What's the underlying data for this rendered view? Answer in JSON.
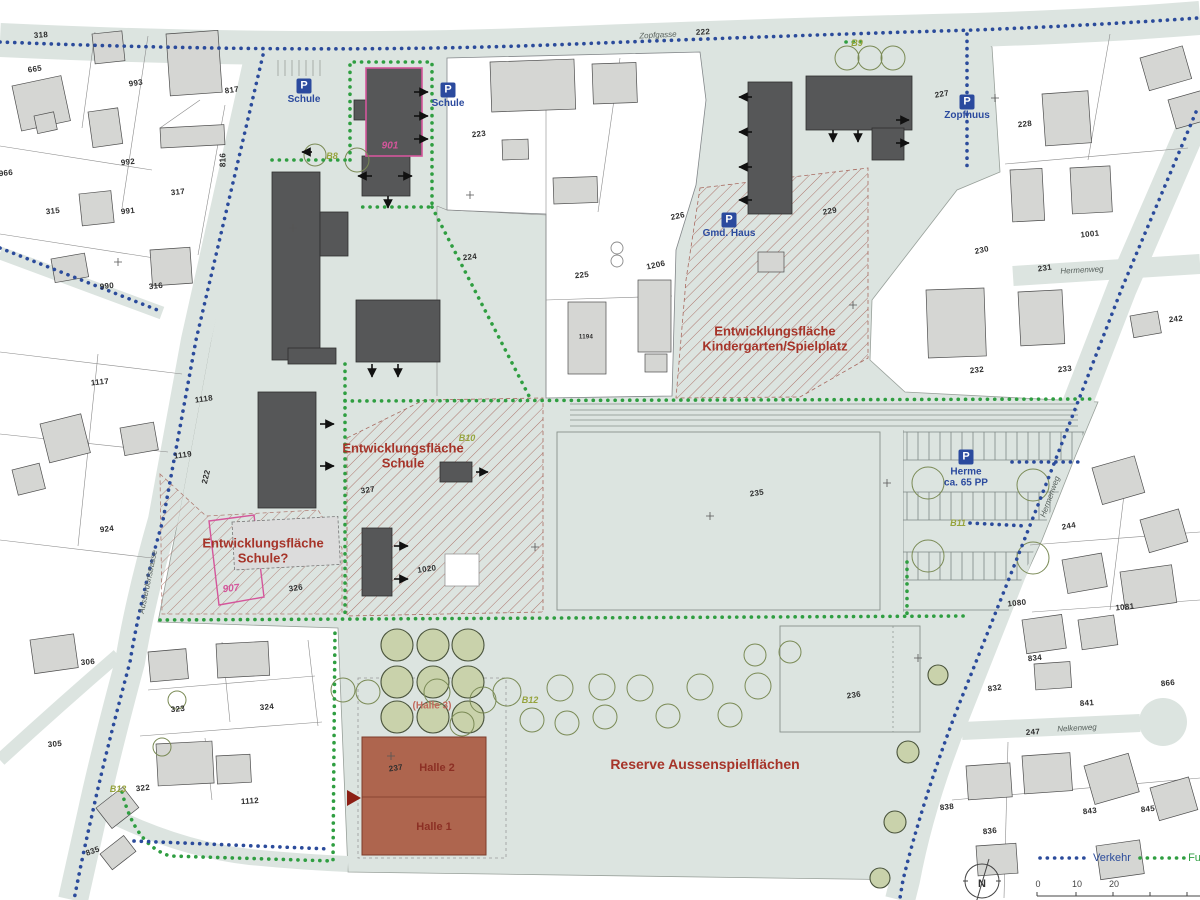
{
  "colors": {
    "campus": "#dce4e0",
    "house": "#d5d6d3",
    "dark_building": "#565758",
    "halle": "#ae654e",
    "hatch": "#a86a60",
    "pink": "#d4569b",
    "olive": "#96a33c",
    "zone_red": "#a63429",
    "verkehr_blue": "#2b4b9b",
    "fussweg_green": "#2f9e41"
  },
  "legend": {
    "verkehr_label": "Verkehr",
    "fuss_label": "Fuss",
    "north_label": "N"
  },
  "scale": {
    "ticks": [
      {
        "text": "0",
        "x": 1038,
        "y": 884
      },
      {
        "text": "10",
        "x": 1077,
        "y": 884
      },
      {
        "text": "20",
        "x": 1114,
        "y": 884
      }
    ]
  },
  "parking": [
    {
      "icon": "P",
      "lines": [
        "Schule"
      ],
      "x": 304,
      "y": 86
    },
    {
      "icon": "P",
      "lines": [
        "Schule"
      ],
      "x": 448,
      "y": 90
    },
    {
      "icon": "P",
      "lines": [
        "Zopfhuus"
      ],
      "x": 967,
      "y": 102
    },
    {
      "icon": "P",
      "lines": [
        "Gmd. Haus"
      ],
      "x": 729,
      "y": 220
    },
    {
      "icon": "P",
      "lines": [
        "Herme",
        "ca. 65 PP"
      ],
      "x": 966,
      "y": 457
    }
  ],
  "zone_labels": [
    {
      "name": "zone-kindergarten",
      "lines": [
        "Entwicklungsfläche",
        "Kindergarten/Spielplatz"
      ],
      "x": 775,
      "y": 339,
      "size": 13
    },
    {
      "name": "zone-schule",
      "lines": [
        "Entwicklungsfläche",
        "Schule"
      ],
      "x": 403,
      "y": 456,
      "size": 13
    },
    {
      "name": "zone-schule-frage",
      "lines": [
        "Entwicklungsfläche",
        "Schule?"
      ],
      "x": 263,
      "y": 551,
      "size": 13
    },
    {
      "name": "zone-reserve",
      "lines": [
        "Reserve Aussenspielflächen"
      ],
      "x": 705,
      "y": 765,
      "size": 14
    },
    {
      "name": "halle-2-label",
      "lines": [
        "Halle 2"
      ],
      "x": 437,
      "y": 768,
      "size": 11,
      "color": "#8c2f24"
    },
    {
      "name": "halle-1-label",
      "lines": [
        "Halle 1"
      ],
      "x": 434,
      "y": 827,
      "size": 11,
      "color": "#8c2f24"
    },
    {
      "name": "halle-3-label",
      "lines": [
        "(Halle 3)"
      ],
      "x": 432,
      "y": 706,
      "size": 10,
      "color": "#c26b5e"
    }
  ],
  "pink_labels": [
    {
      "name": "building-901-label",
      "text": "901",
      "x": 390,
      "y": 146,
      "rot": 0
    },
    {
      "name": "building-907-label",
      "text": "907",
      "x": 231,
      "y": 589,
      "rot": -6
    }
  ],
  "b_labels": [
    {
      "text": "B8",
      "x": 332,
      "y": 156
    },
    {
      "text": "B9",
      "x": 857,
      "y": 43
    },
    {
      "text": "B10",
      "x": 467,
      "y": 438
    },
    {
      "text": "B11",
      "x": 958,
      "y": 523
    },
    {
      "text": "B12",
      "x": 530,
      "y": 700
    },
    {
      "text": "B13",
      "x": 118,
      "y": 789
    }
  ],
  "street_labels": [
    {
      "text": "Zopfgasse",
      "x": 658,
      "y": 36,
      "rot": -3
    },
    {
      "text": "Hermenweg",
      "x": 1082,
      "y": 271,
      "rot": -3
    },
    {
      "text": "Hermenweg",
      "x": 1051,
      "y": 497,
      "rot": -70
    },
    {
      "text": "Nelkenweg",
      "x": 1077,
      "y": 729,
      "rot": -3
    },
    {
      "text": "Ausserdorfstrasse",
      "x": 149,
      "y": 582,
      "rot": -78
    }
  ],
  "parcel_labels": [
    {
      "text": "318",
      "x": 41,
      "y": 36,
      "rot": -4
    },
    {
      "text": "665",
      "x": 35,
      "y": 70,
      "rot": -8
    },
    {
      "text": "993",
      "x": 136,
      "y": 84,
      "rot": -8
    },
    {
      "text": "817",
      "x": 232,
      "y": 91,
      "rot": -8
    },
    {
      "text": "992",
      "x": 128,
      "y": 163,
      "rot": -6
    },
    {
      "text": "816",
      "x": 224,
      "y": 160,
      "rot": -90
    },
    {
      "text": "991",
      "x": 128,
      "y": 212,
      "rot": -6
    },
    {
      "text": "315",
      "x": 53,
      "y": 212,
      "rot": -6
    },
    {
      "text": "317",
      "x": 178,
      "y": 193,
      "rot": -6
    },
    {
      "text": "966",
      "x": 6,
      "y": 174,
      "rot": -6
    },
    {
      "text": "990",
      "x": 107,
      "y": 287,
      "rot": -6
    },
    {
      "text": "316",
      "x": 156,
      "y": 287,
      "rot": -6
    },
    {
      "text": "1117",
      "x": 100,
      "y": 383,
      "rot": -6
    },
    {
      "text": "1118",
      "x": 204,
      "y": 400,
      "rot": -8
    },
    {
      "text": "1119",
      "x": 183,
      "y": 456,
      "rot": -8
    },
    {
      "text": "924",
      "x": 107,
      "y": 530,
      "rot": -6
    },
    {
      "text": "222",
      "x": 207,
      "y": 477,
      "rot": -76
    },
    {
      "text": "306",
      "x": 88,
      "y": 663,
      "rot": -5
    },
    {
      "text": "323",
      "x": 178,
      "y": 710,
      "rot": -5
    },
    {
      "text": "324",
      "x": 267,
      "y": 708,
      "rot": -5
    },
    {
      "text": "305",
      "x": 55,
      "y": 745,
      "rot": -5
    },
    {
      "text": "322",
      "x": 143,
      "y": 789,
      "rot": -6
    },
    {
      "text": "835",
      "x": 93,
      "y": 852,
      "rot": -20
    },
    {
      "text": "1112",
      "x": 250,
      "y": 802,
      "rot": -4
    },
    {
      "text": "223",
      "x": 479,
      "y": 135,
      "rot": -6
    },
    {
      "text": "224",
      "x": 470,
      "y": 258,
      "rot": -6
    },
    {
      "text": "225",
      "x": 582,
      "y": 276,
      "rot": -6
    },
    {
      "text": "226",
      "x": 678,
      "y": 217,
      "rot": -12
    },
    {
      "text": "1206",
      "x": 656,
      "y": 266,
      "rot": -12
    },
    {
      "text": "1194",
      "x": 586,
      "y": 338,
      "rot": 0,
      "size": 6
    },
    {
      "text": "227",
      "x": 942,
      "y": 95,
      "rot": -10
    },
    {
      "text": "228",
      "x": 1025,
      "y": 125,
      "rot": -6
    },
    {
      "text": "229",
      "x": 830,
      "y": 212,
      "rot": -10
    },
    {
      "text": "230",
      "x": 982,
      "y": 251,
      "rot": -12
    },
    {
      "text": "231",
      "x": 1045,
      "y": 269,
      "rot": -8
    },
    {
      "text": "232",
      "x": 977,
      "y": 371,
      "rot": -6
    },
    {
      "text": "233",
      "x": 1065,
      "y": 370,
      "rot": -6
    },
    {
      "text": "242",
      "x": 1176,
      "y": 320,
      "rot": -6
    },
    {
      "text": "1001",
      "x": 1090,
      "y": 235,
      "rot": -6
    },
    {
      "text": "244",
      "x": 1069,
      "y": 527,
      "rot": -10
    },
    {
      "text": "235",
      "x": 757,
      "y": 494,
      "rot": -8
    },
    {
      "text": "236",
      "x": 854,
      "y": 696,
      "rot": -8
    },
    {
      "text": "237",
      "x": 396,
      "y": 769,
      "rot": -8
    },
    {
      "text": "326",
      "x": 296,
      "y": 589,
      "rot": -8
    },
    {
      "text": "327",
      "x": 368,
      "y": 491,
      "rot": -8
    },
    {
      "text": "1020",
      "x": 427,
      "y": 570,
      "rot": -8
    },
    {
      "text": "1080",
      "x": 1017,
      "y": 604,
      "rot": -6
    },
    {
      "text": "1081",
      "x": 1125,
      "y": 608,
      "rot": -6
    },
    {
      "text": "866",
      "x": 1168,
      "y": 684,
      "rot": -6
    },
    {
      "text": "832",
      "x": 995,
      "y": 689,
      "rot": -8
    },
    {
      "text": "834",
      "x": 1035,
      "y": 659,
      "rot": -6
    },
    {
      "text": "841",
      "x": 1087,
      "y": 704,
      "rot": -4
    },
    {
      "text": "247",
      "x": 1033,
      "y": 733,
      "rot": -4
    },
    {
      "text": "838",
      "x": 947,
      "y": 808,
      "rot": -6
    },
    {
      "text": "836",
      "x": 990,
      "y": 832,
      "rot": -6
    },
    {
      "text": "843",
      "x": 1090,
      "y": 812,
      "rot": -6
    },
    {
      "text": "845",
      "x": 1148,
      "y": 810,
      "rot": -6
    },
    {
      "text": "222",
      "x": 703,
      "y": 33,
      "rot": -3
    }
  ]
}
